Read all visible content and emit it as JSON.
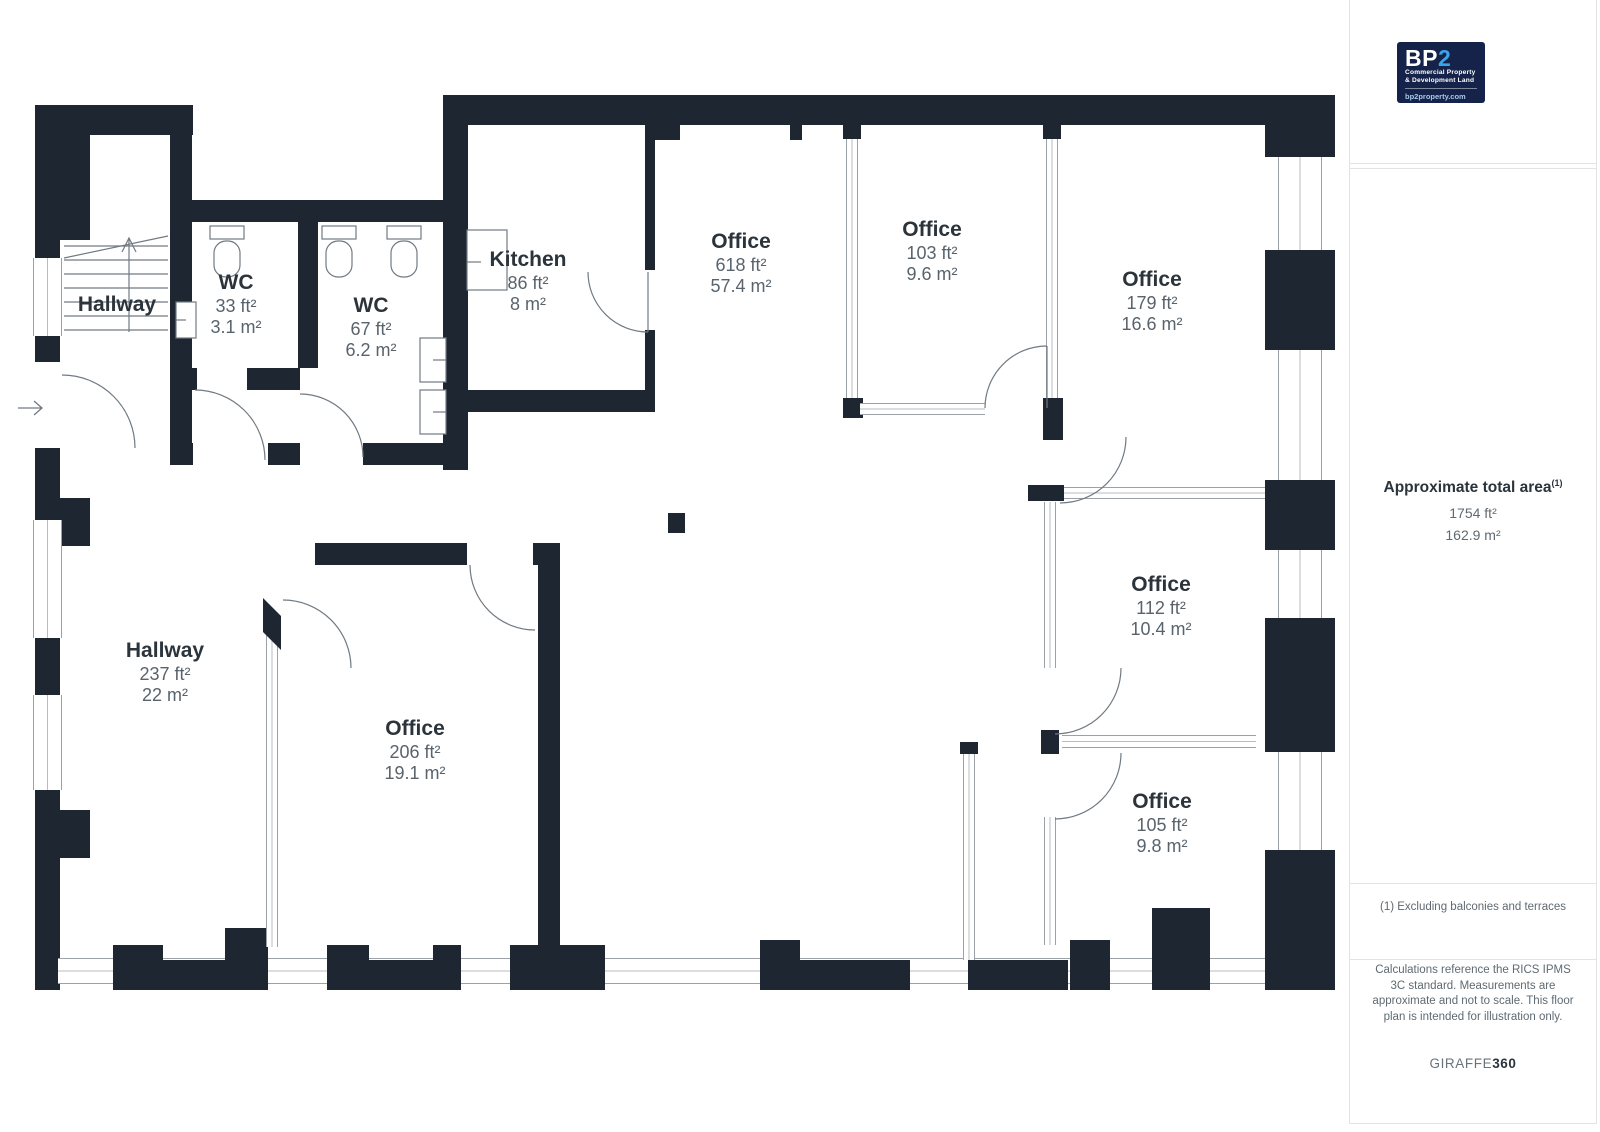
{
  "branding": {
    "logo": {
      "bp": "BP",
      "two": "2",
      "tagline1": "Commercial Property",
      "tagline2": "& Development Land",
      "site": "bp2property.com",
      "navy": "#15234a",
      "accent_blue": "#3ba3e8"
    }
  },
  "sidebar": {
    "total_area": {
      "title": "Approximate total area",
      "superscript": "(1)",
      "value_ft": "1754 ft²",
      "value_m": "162.9 m²"
    },
    "note": "(1) Excluding balconies and terraces",
    "disclaimer": "Calculations reference the RICS IPMS 3C standard. Measurements are approximate and not to scale. This floor plan is intended for illustration only.",
    "credit_brand": "GIRAFFE",
    "credit_suffix": "360"
  },
  "floorplan": {
    "wall_color": "#1e2731",
    "rooms": [
      {
        "name": "Hallway",
        "ft": "",
        "m": ""
      },
      {
        "name": "WC",
        "ft": "33 ft²",
        "m": "3.1 m²"
      },
      {
        "name": "WC",
        "ft": "67 ft²",
        "m": "6.2 m²"
      },
      {
        "name": "Kitchen",
        "ft": "86 ft²",
        "m": "8 m²"
      },
      {
        "name": "Office",
        "ft": "618 ft²",
        "m": "57.4 m²"
      },
      {
        "name": "Office",
        "ft": "103 ft²",
        "m": "9.6 m²"
      },
      {
        "name": "Office",
        "ft": "179 ft²",
        "m": "16.6 m²"
      },
      {
        "name": "Office",
        "ft": "112 ft²",
        "m": "10.4 m²"
      },
      {
        "name": "Office",
        "ft": "105 ft²",
        "m": "9.8 m²"
      },
      {
        "name": "Hallway",
        "ft": "237 ft²",
        "m": "22 m²"
      },
      {
        "name": "Office",
        "ft": "206 ft²",
        "m": "19.1 m²"
      }
    ]
  }
}
